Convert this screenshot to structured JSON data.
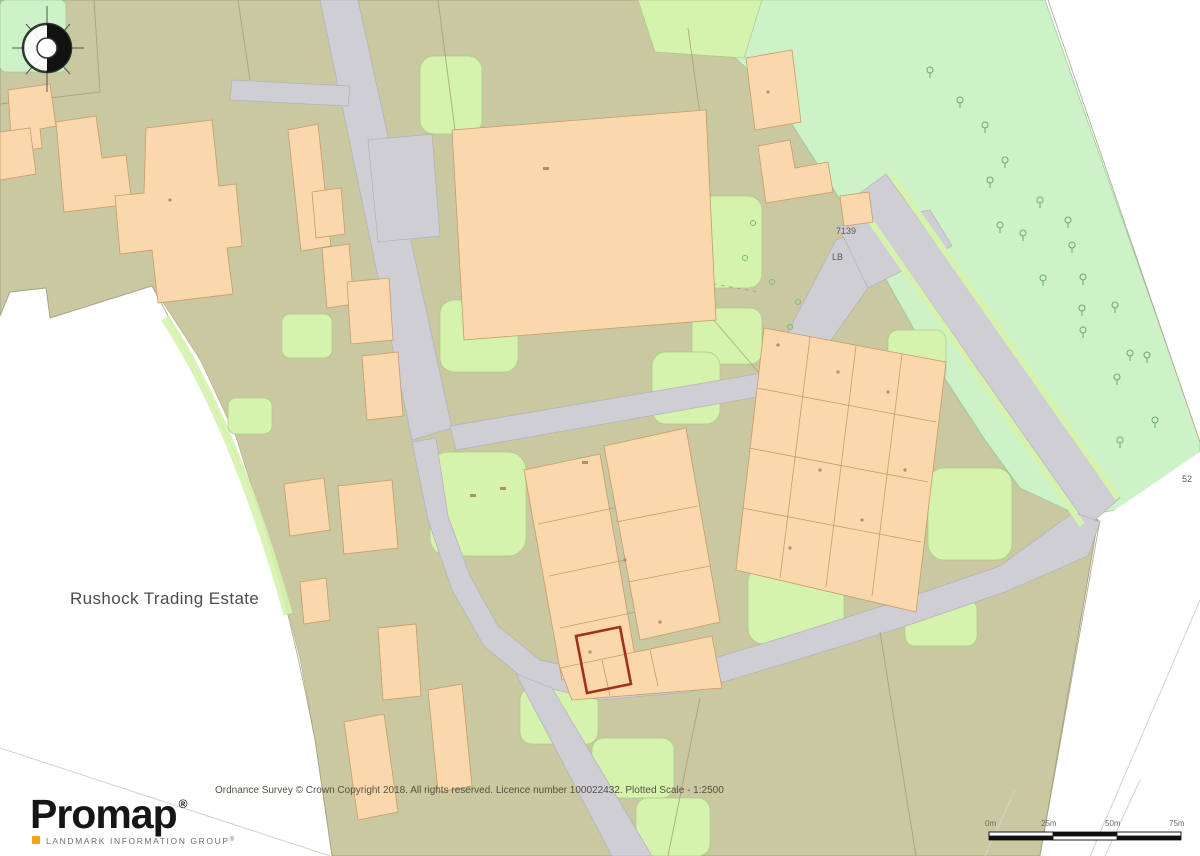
{
  "map": {
    "estate_label": "Rushock Trading Estate",
    "labels": {
      "building_number": "7139",
      "letter_box": "LB",
      "parcel_number": "52"
    }
  },
  "branding": {
    "logo": "Promap",
    "logo_mark": "®",
    "tagline": "LANDMARK INFORMATION GROUP",
    "tagline_mark": "®"
  },
  "footer": {
    "copyright": "Ordnance Survey © Crown Copyright 2018. All rights reserved. Licence number 100022432. Plotted Scale - 1:2500"
  },
  "scale_bar": {
    "labels": [
      "0m",
      "25m",
      "50m",
      "75m"
    ]
  },
  "colors": {
    "land": "#cac8a0",
    "mint": "#cdf2c8",
    "green": "#d6f3ae",
    "road": "#cfced4",
    "building": "#fad8ac",
    "highlight": "#a1301c",
    "logo_accent": "#f2a21b"
  }
}
